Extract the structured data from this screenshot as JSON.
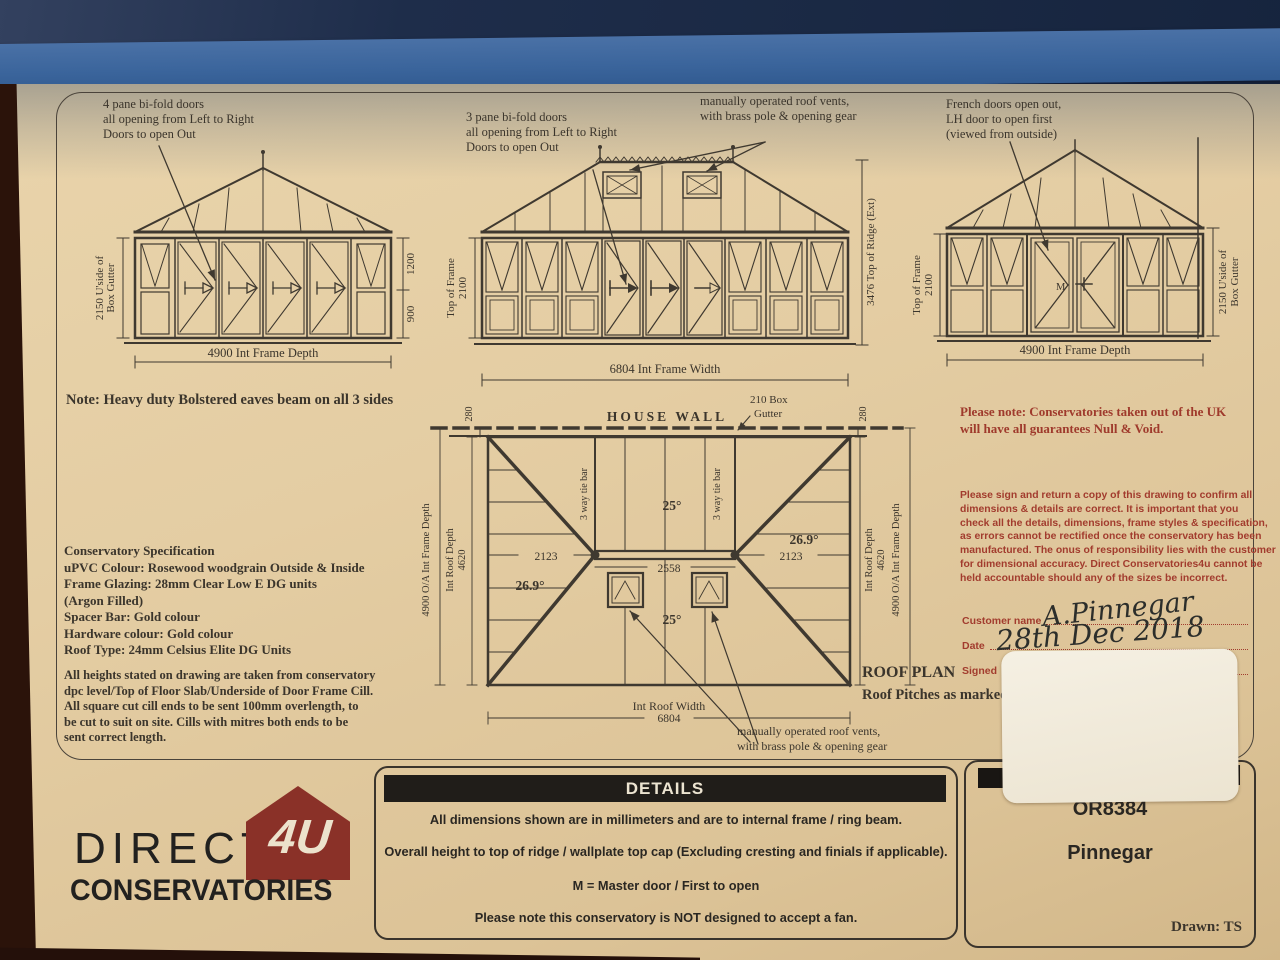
{
  "colors": {
    "paper": "#e4cda3",
    "ink": "#3b352c",
    "red_print": "#9f3a2c",
    "logo_red": "#8a3128",
    "tape_blue": "#41699f"
  },
  "shared": {
    "d4900": "4900 Int Frame Depth",
    "u2150a": "2150 U'side of",
    "u2150b": "Box Gutter",
    "top_frame": "Top of Frame",
    "h2100": "2100"
  },
  "elev_a": {
    "note": "4 pane bi-fold doors\nall opening from Left to Right\nDoors to open Out",
    "d1200": "1200",
    "d900": "900"
  },
  "elev_b": {
    "note_doors": "3 pane bi-fold doors\nall opening from Left to Right\nDoors to open Out",
    "note_vents": "manually operated roof vents,\nwith brass pole & opening gear",
    "d3476": "3476 Top of Ridge (Ext)",
    "d6804": "6804 Int Frame Width"
  },
  "elev_c": {
    "note": "French doors open out,\nLH door to open first\n(viewed from outside)",
    "master": "M"
  },
  "roof_plan": {
    "house_wall": "HOUSE WALL",
    "box_gutter1": "210 Box",
    "box_gutter2": "Gutter",
    "d280": "280",
    "tie_bar": "3 way tie bar",
    "p25": "25°",
    "p269": "26.9°",
    "d2123": "2123",
    "d2558": "2558",
    "oa_depth": "4900 O/A Int Frame Depth",
    "roof_depth": "Int Roof Depth",
    "d4620": "4620",
    "width_label": "Int Roof Width",
    "d6804": "6804",
    "title": "ROOF PLAN",
    "subtitle": "Roof Pitches as marked",
    "vents_note": "manually operated roof vents,\nwith brass pole & opening gear"
  },
  "notes": {
    "eaves": "Note: Heavy duty Bolstered eaves beam on all 3 sides",
    "spec": "Conservatory Specification\nuPVC Colour: Rosewood woodgrain Outside & Inside\nFrame Glazing: 28mm Clear Low E DG units\n(Argon Filled)\nSpacer Bar: Gold colour\nHardware colour: Gold colour\nRoof Type: 24mm Celsius Elite DG Units",
    "heights": "All heights stated on drawing are taken from conservatory\ndpc level/Top of Floor Slab/Underside of Door Frame Cill.\nAll square cut cill ends to be sent 100mm overlength, to\nbe cut to suit on site. Cills with mitres both ends to be\nsent correct length."
  },
  "red": {
    "uk_note": "Please note: Conservatories taken out of the UK\nwill have all guarantees Null & Void.",
    "sign_note": "Please sign and return a copy of this drawing to confirm all\ndimensions & details are correct. It is important that you\ncheck all the details, dimensions, frame styles & specification,\nas errors cannot be rectified once the conservatory has been\nmanufactured. The onus of responsibility lies with the customer\nfor dimensional accuracy. Direct Conservatories4u cannot be\nheld accountable should any of the sizes be incorrect.",
    "customer_label": "Customer name",
    "date_label": "Date",
    "signed_label": "Signed"
  },
  "handwriting": {
    "customer": "A.Pinnegar",
    "date": "28th Dec 2018"
  },
  "details": {
    "title": "DETAILS",
    "lines": [
      "All dimensions shown are in millimeters and are to internal frame / ring beam.",
      "Overall height to top of ridge / wallplate top cap (Excluding cresting and finials if applicable).",
      "M = Master door / First to open",
      "Please note this conservatory is NOT designed to accept a fan."
    ]
  },
  "logo": {
    "word1": "DIRECT",
    "badge": "4U",
    "word2": "CONSERVATORIES"
  },
  "order": {
    "number": "OR8384",
    "customer": "Pinnegar",
    "drawn": "Drawn: TS"
  }
}
